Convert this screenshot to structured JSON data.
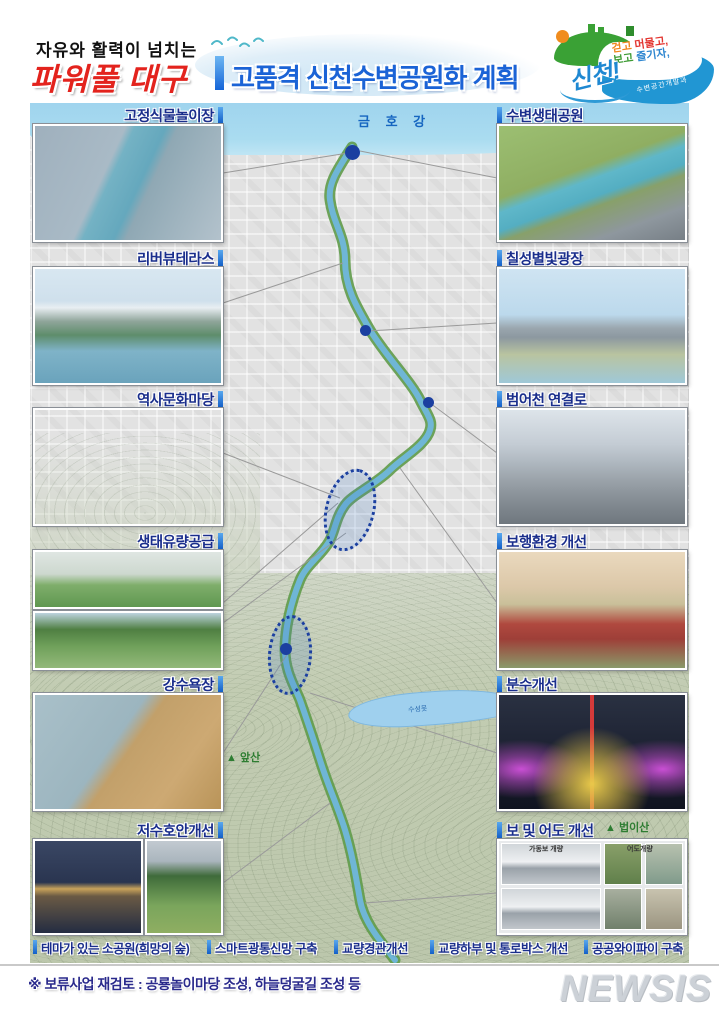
{
  "header": {
    "tagline": "자유와 활력이 넘치는",
    "brand": "파워풀 대구",
    "title": "고품격 신천수변공원화 계획",
    "logo": {
      "name": "신천!",
      "slogan_words": [
        "걷고",
        "머물고,",
        "보고",
        "즐기자,"
      ],
      "slogan_colors": [
        "#f0861e",
        "#e3342f",
        "#3f9c35",
        "#2e86d0"
      ],
      "sub": "수변공간개발과"
    }
  },
  "left_cards": [
    {
      "label": "고정식물놀이장"
    },
    {
      "label": "리버뷰테라스"
    },
    {
      "label": "역사문화마당"
    },
    {
      "label": "생태유량공급"
    },
    {
      "label": "강수욕장"
    },
    {
      "label": "저수호안개선"
    }
  ],
  "right_cards": [
    {
      "label": "수변생태공원"
    },
    {
      "label": "칠성별빛광장"
    },
    {
      "label": "범어천 연결로"
    },
    {
      "label": "보행환경 개선"
    },
    {
      "label": "분수개선"
    },
    {
      "label": "보 및 어도 개선"
    }
  ],
  "bottom_labels": [
    {
      "label": "테마가 있는 소공원(희망의 숲)"
    },
    {
      "label": "스마트광통신망 구축"
    },
    {
      "label": "교량경관개선"
    },
    {
      "label": "교량하부 및 통로박스 개선"
    },
    {
      "label": "공공와이파이 구축"
    }
  ],
  "map": {
    "labels": {
      "river_top": "금 호 강",
      "lake": "수성못",
      "mountain_left": "▲ 앞산",
      "mountain_right": "▲ 법이산"
    },
    "accent_colors": {
      "route_dashed": "#1b3fa0",
      "river": "#6fb6d6",
      "bank_green": "#5f9b4a"
    }
  },
  "collage": {
    "caption_weir": "가동보 개량",
    "caption_fishway": "어도개량"
  },
  "footnote": "※ 보류사업 재검토 : 공룡놀이마당 조성, 하늘덩굴길 조성 등",
  "watermark": "NEWSIS"
}
